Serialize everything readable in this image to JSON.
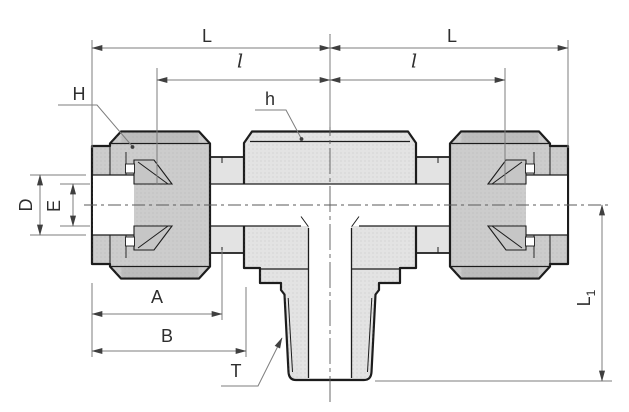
{
  "page": {
    "description": "Dimensional cross-section drawing of a tee tube fitting with compression nuts on both run ends and a tapered male thread branch",
    "background": "#ffffff"
  },
  "drawing": {
    "outline_color": "#1c1c1c",
    "dim_line_color": "#7d7d7d",
    "label_color": "#2e2e2e",
    "body_fill": "#e3e3e3",
    "nut_fill": "#cccccc",
    "rim_fill": "#bdbdbd",
    "ferrule_fill": "#c6c6c6",
    "bore_fill": "#ffffff",
    "parts": [
      "left-compression-nut",
      "right-compression-nut",
      "center-body-hex",
      "branch-male-thread",
      "ferrules",
      "through-bore",
      "branch-bore"
    ]
  },
  "labels": {
    "overall_length_left": "L",
    "overall_length_right": "L",
    "sub_length_left": "l",
    "sub_length_right": "l",
    "nut_across_flats": "H",
    "body_across_flats": "h",
    "tube_hole_diameter": "D",
    "bore_diameter": "E",
    "dim_a": "A",
    "dim_b": "B",
    "thread_callout": "T",
    "branch_length_base": "L",
    "branch_length_subscript": "1"
  }
}
